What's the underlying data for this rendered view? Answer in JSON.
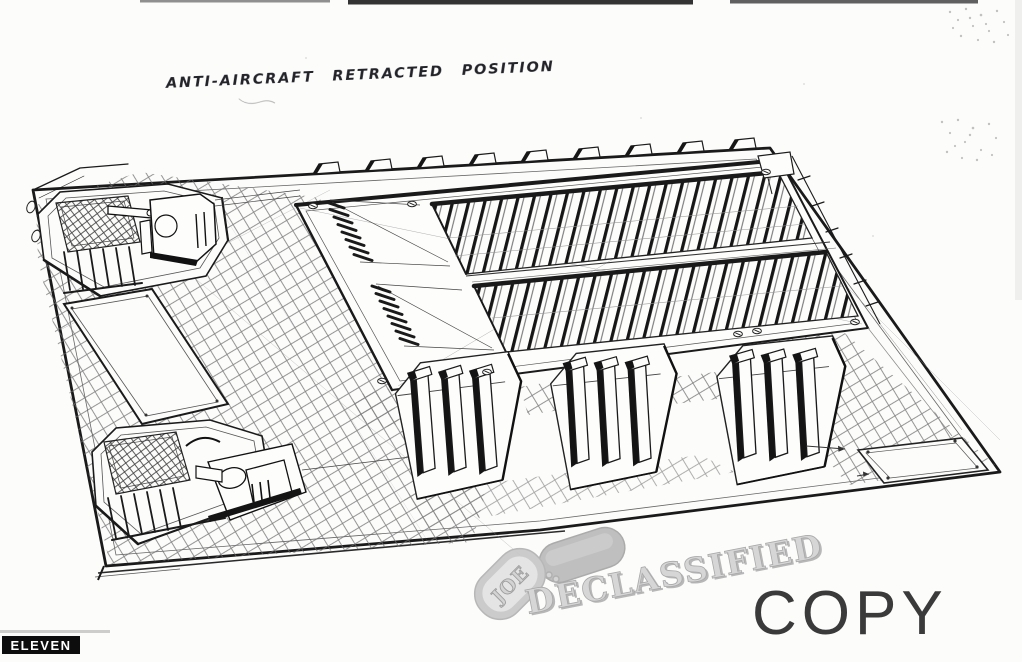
{
  "document": {
    "annotation": "ANTI-AIRCRAFT RETRACTED POSITION",
    "page_label": "ELEVEN",
    "copy_stamp": "COPY",
    "watermark": {
      "tag_text": "JOE",
      "stamp_text": "DECLASSIFIED"
    },
    "colors": {
      "ink": "#1a1a1a",
      "paper": "#fcfcfb",
      "watermark_gray": "#c6c6c6",
      "copy_stamp_gray": "#3a3a3a",
      "page_label_bg": "#0d0d0d",
      "page_label_text": "#ffffff"
    }
  }
}
